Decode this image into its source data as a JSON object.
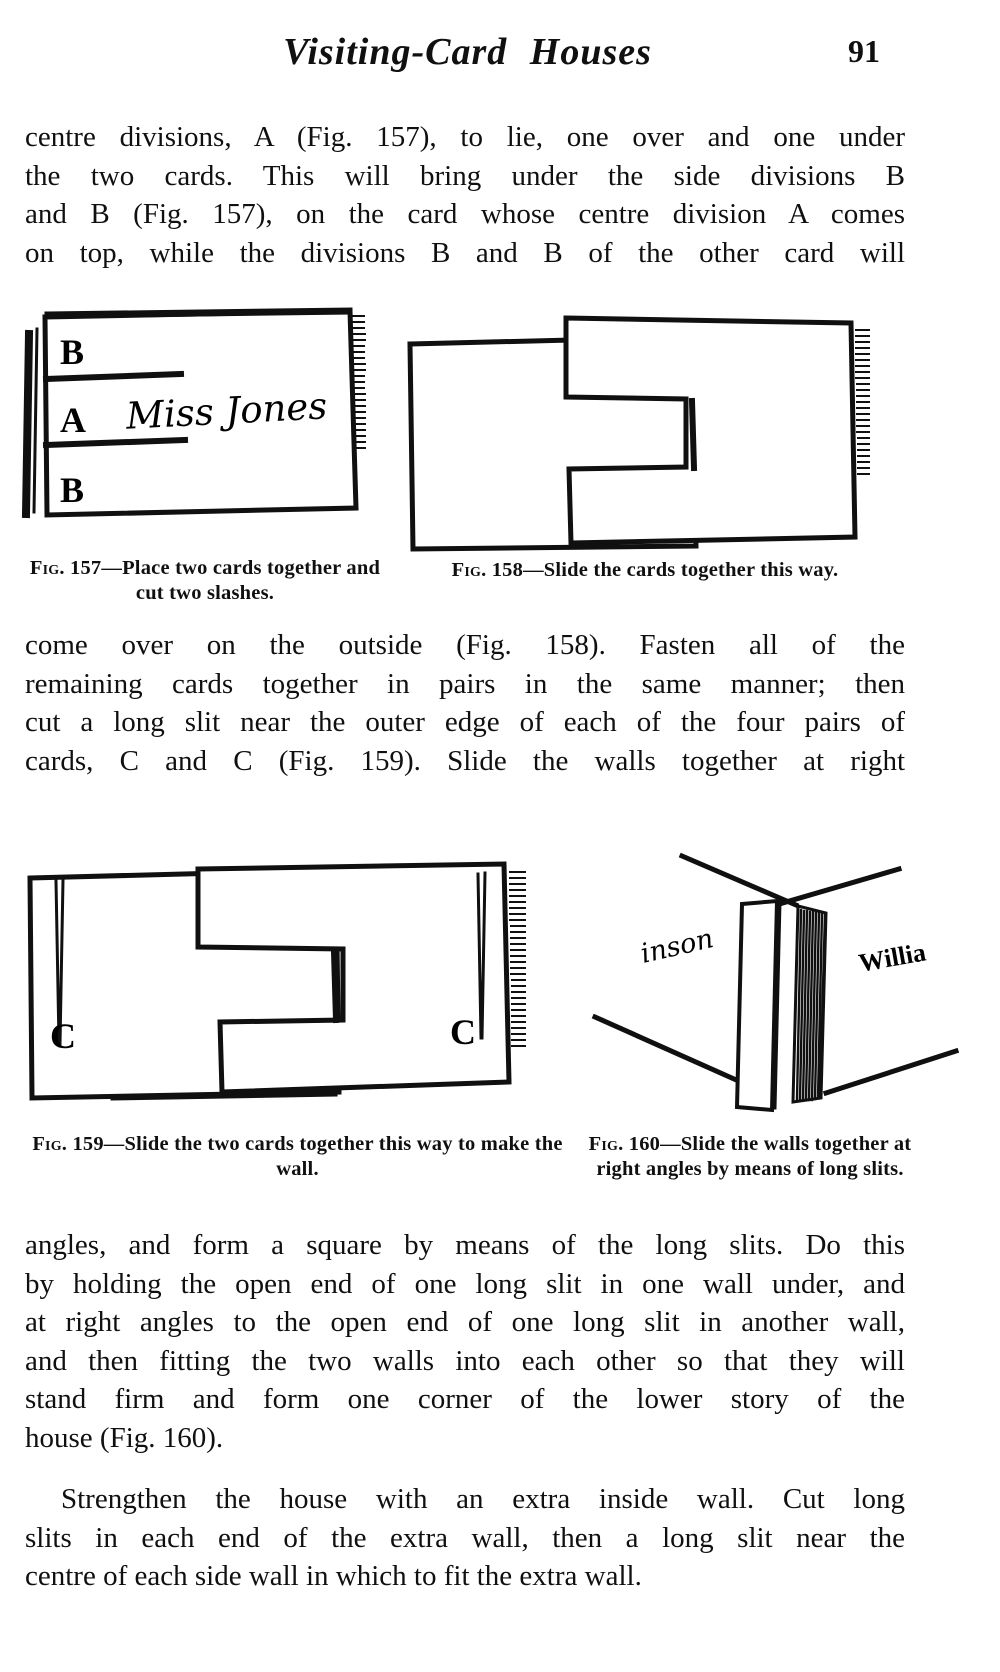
{
  "header": {
    "title": "Visiting-Card Houses",
    "page_number": "91"
  },
  "paragraphs": {
    "p1": {
      "lines": [
        "centre divisions, A (Fig. 157), to lie, one over and one under",
        "the two cards.  This will bring under the side divisions B",
        "and B (Fig. 157), on the card whose centre division A comes",
        "on top, while the divisions B and B of the other card will"
      ]
    },
    "p2": {
      "lines": [
        "come over on the outside (Fig. 158).  Fasten all of the",
        "remaining cards together in pairs in the same manner; then",
        "cut a long slit near the outer edge of each of the four pairs of",
        "cards, C and C (Fig. 159).  Slide the walls together at right"
      ]
    },
    "p3": {
      "lines": [
        "angles, and form a square by means of the long slits.  Do this",
        "by holding the open end of one long slit in one wall under, and",
        "at right angles to the open end of one long slit in another wall,",
        "and then fitting the two walls into each other so that they will",
        "stand firm and form one corner of the lower story of the",
        "house (Fig. 160)."
      ]
    },
    "p4": {
      "lines": [
        "Strengthen the house with an extra inside wall.  Cut long",
        "slits in each end of the extra wall, then a long slit near the",
        "centre of each side wall in which to fit the extra wall."
      ]
    }
  },
  "figures": {
    "fig157": {
      "label_top": "B",
      "label_middle": "A",
      "label_bottom": "B",
      "script_name": "Miss Jones",
      "caption_label": "Fig. 157",
      "caption_text": "—Place two cards together and cut two slashes."
    },
    "fig158": {
      "caption_label": "Fig. 158",
      "caption_text": "—Slide the cards together this way."
    },
    "fig159": {
      "label_left": "C",
      "label_right": "C",
      "caption_label": "Fig. 159",
      "caption_text": "—Slide the two cards together this way to make the wall."
    },
    "fig160": {
      "script_left": "inson",
      "script_right": "Willia",
      "caption_label": "Fig. 160",
      "caption_text": "—Slide the walls together at right angles by means of long slits."
    }
  }
}
